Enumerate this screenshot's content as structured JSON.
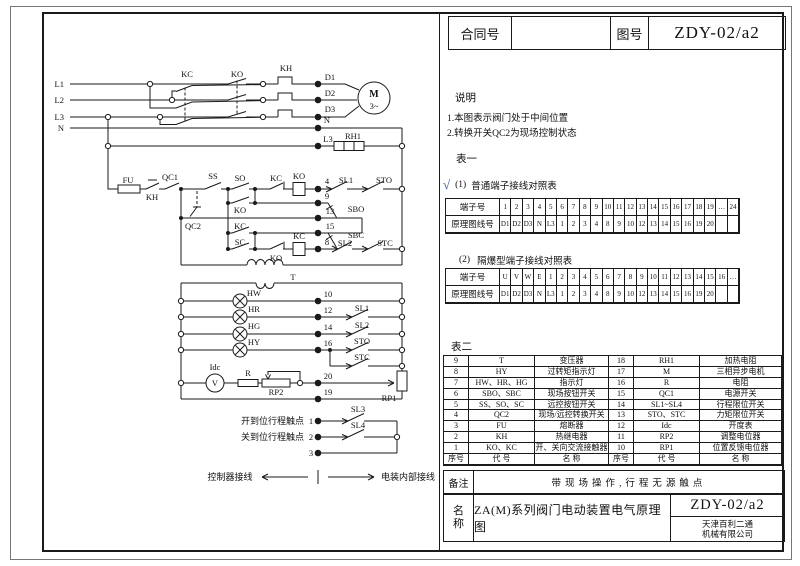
{
  "header": {
    "contract_label": "合同号",
    "contract_value": "",
    "drawing_no_label": "图号",
    "drawing_no_value": "ZDY-02/a2"
  },
  "notes": {
    "heading": "说明",
    "items": [
      "1.本图表示阀门处于中间位置",
      "2.转换开关QC2为现场控制状态"
    ]
  },
  "table1": {
    "heading": "表一",
    "check": "√",
    "sub1_label": "(1)",
    "sub1_title": "普通端子接线对照表",
    "sub2_label": "(2)",
    "sub2_title": "隔爆型端子接线对照表",
    "row_labels": [
      "端子号",
      "原理图线号"
    ],
    "ordinary": {
      "terminals": [
        "1",
        "2",
        "3",
        "4",
        "5",
        "6",
        "7",
        "8",
        "9",
        "10",
        "11",
        "12",
        "13",
        "14",
        "15",
        "16",
        "17",
        "18",
        "19",
        "…",
        "24"
      ],
      "wires": [
        "D1",
        "D2",
        "D3",
        "N",
        "L3",
        "1",
        "2",
        "3",
        "4",
        "8",
        "9",
        "10",
        "12",
        "13",
        "14",
        "15",
        "16",
        "19",
        "20",
        "",
        ""
      ]
    },
    "exproof": {
      "terminals": [
        "U",
        "V",
        "W",
        "E",
        "1",
        "2",
        "3",
        "4",
        "5",
        "6",
        "7",
        "8",
        "9",
        "10",
        "11",
        "12",
        "13",
        "14",
        "15",
        "16",
        "…"
      ],
      "wires": [
        "D1",
        "D2",
        "D3",
        "N",
        "L3",
        "1",
        "2",
        "3",
        "4",
        "8",
        "9",
        "10",
        "12",
        "13",
        "14",
        "15",
        "16",
        "19",
        "20",
        "",
        ""
      ]
    }
  },
  "table2": {
    "heading": "表二",
    "header": [
      "序号",
      "代 号",
      "名 称",
      "序号",
      "代 号",
      "名 称"
    ],
    "rows": [
      [
        "9",
        "T",
        "变压器",
        "18",
        "RH1",
        "加热电阻"
      ],
      [
        "8",
        "HY",
        "过转矩指示灯",
        "17",
        "M",
        "三相异步电机"
      ],
      [
        "7",
        "HW、HR、HG",
        "指示灯",
        "16",
        "R",
        "电阻"
      ],
      [
        "6",
        "SBO、SBC",
        "现场按钮开关",
        "15",
        "QC1",
        "电源开关"
      ],
      [
        "5",
        "SS、SO、SC",
        "远控按钮开关",
        "14",
        "SL1~SL4",
        "行程限位开关"
      ],
      [
        "4",
        "QC2",
        "现场/远控转换开关",
        "13",
        "STO、STC",
        "力矩限位开关"
      ],
      [
        "3",
        "FU",
        "熔断器",
        "12",
        "Idc",
        "开度表"
      ],
      [
        "2",
        "KH",
        "热继电器",
        "11",
        "RP2",
        "调整电位器"
      ],
      [
        "1",
        "KO、KC",
        "开、关向交流接触器",
        "10",
        "RP1",
        "位置反馈电位器"
      ]
    ]
  },
  "remarks": {
    "label": "备注",
    "text": "带现场操作,行程无源触点"
  },
  "name_block": {
    "label_chars": [
      "名",
      "称"
    ],
    "title": "ZA(M)系列阀门电动装置电气原理图",
    "drawing_no": "ZDY-02/a2",
    "company_line1": "天津百利二通",
    "company_line2": "机械有限公司"
  },
  "schematic": {
    "labels": [
      {
        "t": "L1",
        "x": 64,
        "y": 87,
        "a": "end"
      },
      {
        "t": "L2",
        "x": 64,
        "y": 103,
        "a": "end"
      },
      {
        "t": "L3",
        "x": 64,
        "y": 120,
        "a": "end"
      },
      {
        "t": "N",
        "x": 64,
        "y": 131,
        "a": "end"
      },
      {
        "t": "KC",
        "x": 187,
        "y": 77
      },
      {
        "t": "KO",
        "x": 237,
        "y": 77
      },
      {
        "t": "KH",
        "x": 286,
        "y": 71
      },
      {
        "t": "D1",
        "x": 330,
        "y": 80
      },
      {
        "t": "D2",
        "x": 330,
        "y": 96
      },
      {
        "t": "D3",
        "x": 330,
        "y": 112
      },
      {
        "t": "M",
        "x": 374,
        "y": 97,
        "cls": "b"
      },
      {
        "t": "3~",
        "x": 374,
        "y": 109
      },
      {
        "t": "N",
        "x": 327,
        "y": 123
      },
      {
        "t": "L3",
        "x": 328,
        "y": 142
      },
      {
        "t": "RH1",
        "x": 353,
        "y": 139
      },
      {
        "t": "FU",
        "x": 128,
        "y": 183
      },
      {
        "t": "KH",
        "x": 152,
        "y": 200
      },
      {
        "t": "QC1",
        "x": 170,
        "y": 180
      },
      {
        "t": "QC2",
        "x": 193,
        "y": 229
      },
      {
        "t": "SS",
        "x": 213,
        "y": 179
      },
      {
        "t": "SO",
        "x": 240,
        "y": 181
      },
      {
        "t": "KO",
        "x": 240,
        "y": 213
      },
      {
        "t": "KC",
        "x": 276,
        "y": 181
      },
      {
        "t": "KO",
        "x": 299,
        "y": 179
      },
      {
        "t": "KC",
        "x": 240,
        "y": 229
      },
      {
        "t": "SC",
        "x": 240,
        "y": 245
      },
      {
        "t": "KO",
        "x": 276,
        "y": 261
      },
      {
        "t": "KC",
        "x": 299,
        "y": 239
      },
      {
        "t": "4",
        "x": 327,
        "y": 184
      },
      {
        "t": "9",
        "x": 327,
        "y": 199
      },
      {
        "t": "13",
        "x": 330,
        "y": 214
      },
      {
        "t": "15",
        "x": 330,
        "y": 229
      },
      {
        "t": "8",
        "x": 327,
        "y": 245
      },
      {
        "t": "SL1",
        "x": 346,
        "y": 183
      },
      {
        "t": "STO",
        "x": 384,
        "y": 183
      },
      {
        "t": "SBO",
        "x": 356,
        "y": 212
      },
      {
        "t": "SBC",
        "x": 356,
        "y": 238
      },
      {
        "t": "SL2",
        "x": 345,
        "y": 246
      },
      {
        "t": "STC",
        "x": 385,
        "y": 246
      },
      {
        "t": "T",
        "x": 293,
        "y": 280
      },
      {
        "t": "HW",
        "x": 254,
        "y": 296
      },
      {
        "t": "HR",
        "x": 254,
        "y": 312
      },
      {
        "t": "HG",
        "x": 254,
        "y": 329
      },
      {
        "t": "HY",
        "x": 254,
        "y": 345
      },
      {
        "t": "10",
        "x": 328,
        "y": 297
      },
      {
        "t": "12",
        "x": 328,
        "y": 313
      },
      {
        "t": "14",
        "x": 328,
        "y": 330
      },
      {
        "t": "16",
        "x": 328,
        "y": 346
      },
      {
        "t": "SL1",
        "x": 362,
        "y": 311
      },
      {
        "t": "SL2",
        "x": 362,
        "y": 328
      },
      {
        "t": "STO",
        "x": 362,
        "y": 344
      },
      {
        "t": "STC",
        "x": 362,
        "y": 360
      },
      {
        "t": "Idc",
        "x": 215,
        "y": 370
      },
      {
        "t": "V",
        "x": 215,
        "y": 386
      },
      {
        "t": "R",
        "x": 248,
        "y": 376
      },
      {
        "t": "RP2",
        "x": 276,
        "y": 395
      },
      {
        "t": "20",
        "x": 328,
        "y": 379
      },
      {
        "t": "RP1",
        "x": 389,
        "y": 401
      },
      {
        "t": "19",
        "x": 328,
        "y": 395
      },
      {
        "t": "开到位行程触点",
        "x": 304,
        "y": 424,
        "a": "end",
        "cls": "cjk"
      },
      {
        "t": "1",
        "x": 311,
        "y": 424
      },
      {
        "t": "关到位行程触点",
        "x": 304,
        "y": 440,
        "a": "end",
        "cls": "cjk"
      },
      {
        "t": "2",
        "x": 311,
        "y": 440
      },
      {
        "t": "3",
        "x": 311,
        "y": 456
      },
      {
        "t": "SL3",
        "x": 358,
        "y": 412
      },
      {
        "t": "SL4",
        "x": 358,
        "y": 428
      },
      {
        "t": "控制器接线",
        "x": 230,
        "y": 480,
        "cls": "cjk"
      },
      {
        "t": "电装内部接线",
        "x": 408,
        "y": 480,
        "cls": "cjk"
      }
    ]
  }
}
